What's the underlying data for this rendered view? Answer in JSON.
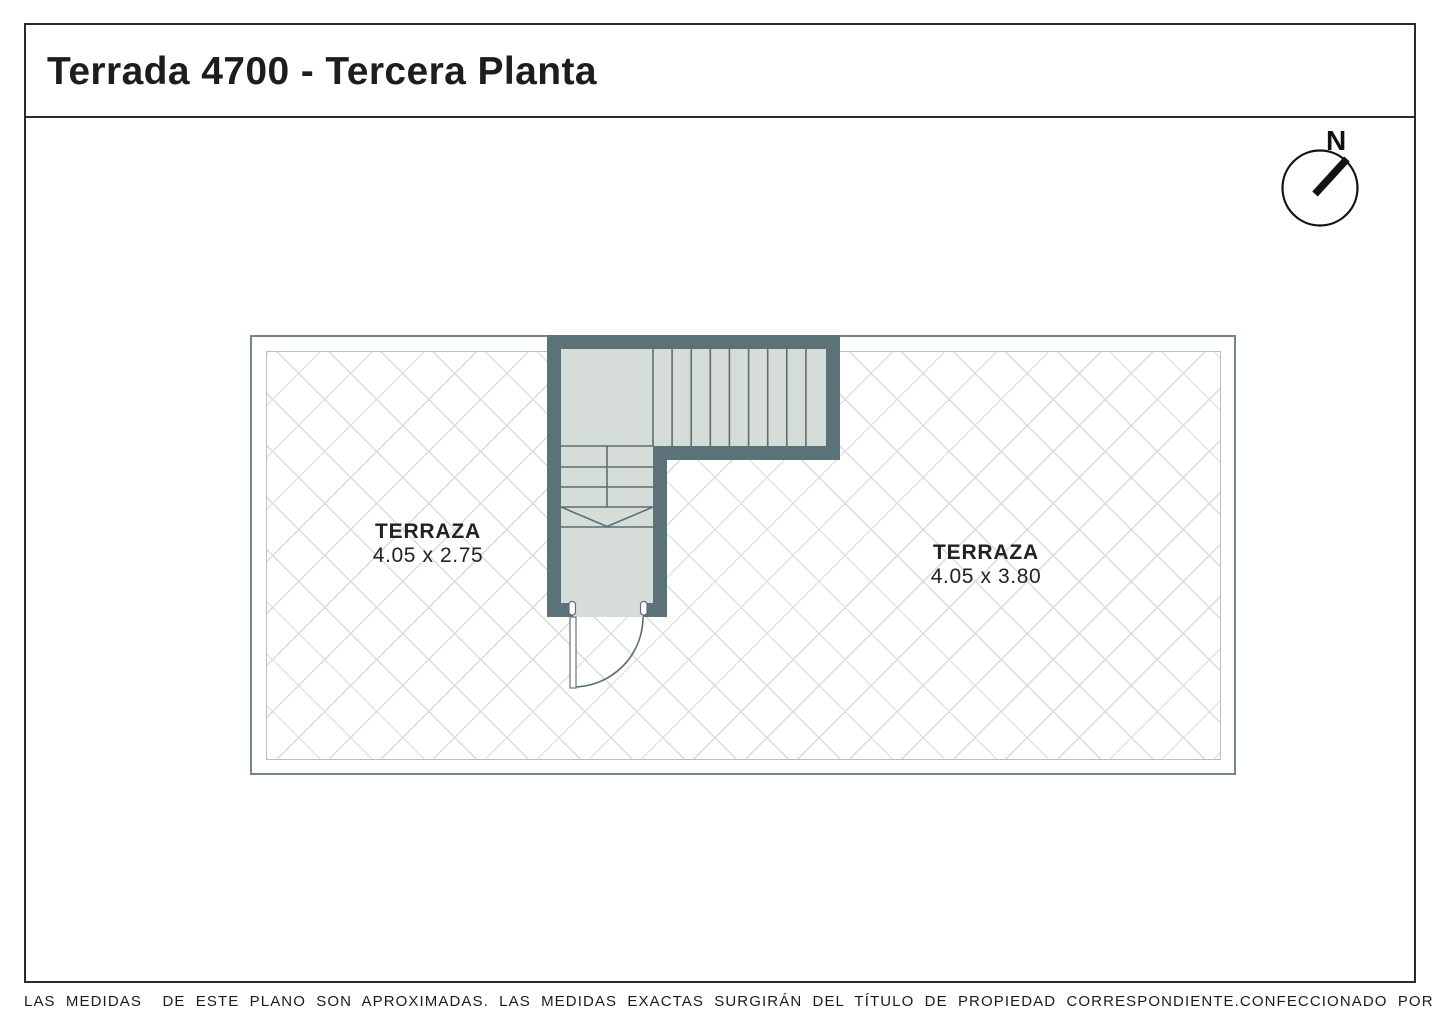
{
  "title": "Terrada 4700 - Tercera Planta",
  "compass": {
    "north_label": "N"
  },
  "plan": {
    "rooms": [
      {
        "name": "TERRAZA",
        "dimensions": "4.05 x 2.75"
      },
      {
        "name": "TERRAZA",
        "dimensions": "4.05 x 3.80"
      }
    ],
    "stair": {
      "treads": 9
    }
  },
  "footer": {
    "disclaimer": "LAS MEDIDAS  DE ESTE PLANO SON APROXIMADAS. LAS MEDIDAS EXACTAS SURGIRÁN DEL TÍTULO DE PROPIEDAD CORRESPONDIENTE.",
    "credit": "CONFECCIONADO POR ESTUDIO NARTEX"
  },
  "colors": {
    "wall": "#5b7279",
    "stair_fill": "#d6dcd8",
    "hatch_line": "#d9dcdd",
    "parapet_outer": "#71868e",
    "parapet_inner": "#b7c0c3",
    "frame": "#2b2b2b"
  }
}
